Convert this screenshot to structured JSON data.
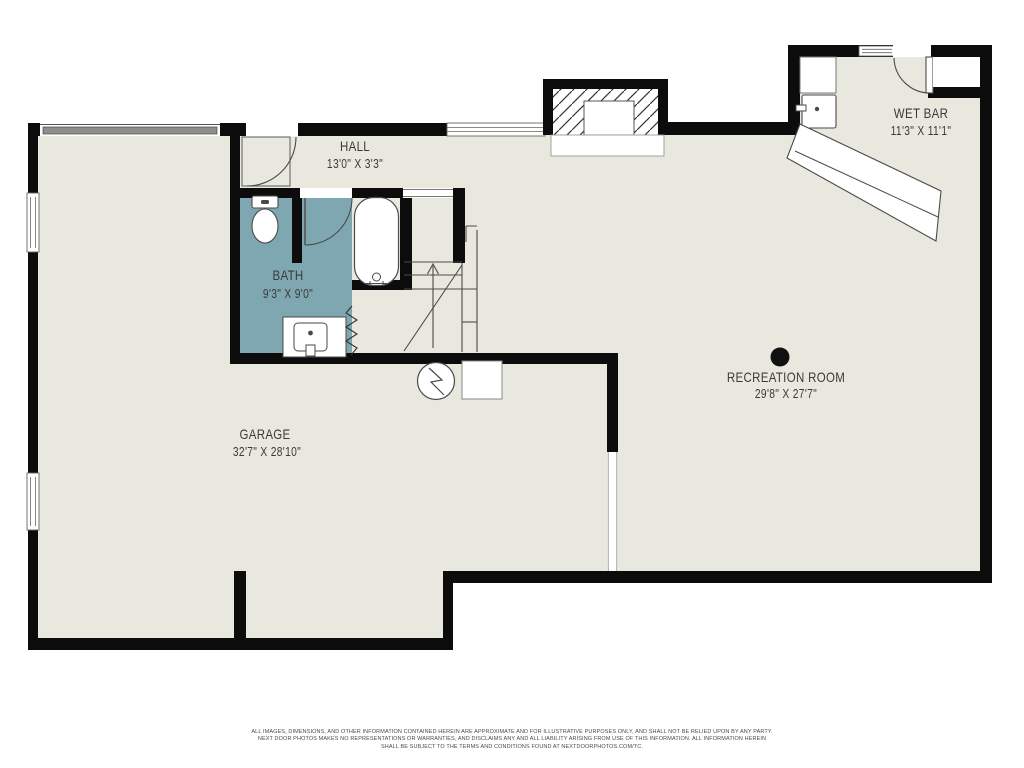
{
  "rooms": [
    {
      "name": "HALL",
      "dims": "13'0\" X 3'3\""
    },
    {
      "name": "BATH",
      "dims": "9'3\" X 9'0\""
    },
    {
      "name": "GARAGE",
      "dims": "32'7\" X 28'10\""
    },
    {
      "name": "RECREATION ROOM",
      "dims": "29'8\" X 27'7\""
    },
    {
      "name": "WET BAR",
      "dims": "11'3\" X 11'1\""
    }
  ],
  "disclaimer": {
    "line1": "ALL IMAGES, DIMENSIONS, AND OTHER INFORMATION CONTAINED HEREIN ARE APPROXIMATE AND FOR ILLUSTRATIVE PURPOSES ONLY, AND SHALL NOT BE RELIED UPON BY ANY PARTY.",
    "line2": "NEXT DOOR PHOTOS MAKES NO REPRESENTATIONS OR WARRANTIES, AND DISCLAIMS ANY AND ALL LIABILITY ARISING FROM USE OF THIS INFORMATION. ALL INFORMATION HEREIN",
    "line3": "SHALL BE SUBJECT TO THE TERMS AND CONDITIONS FOUND AT NEXTDOORPHOTOS.COM/TC."
  },
  "colors": {
    "background": "#ffffff",
    "floor": "#e9e8df",
    "bath_floor": "#7fa7b1",
    "wall": "#0c0c0c",
    "garage_door": "#8e8e8e",
    "fixture_line": "#4a4a4a",
    "label_text": "#3a3a3a"
  },
  "icons": {
    "garage-door": "gray-band",
    "window": "white-band-double-line",
    "door-swing": "quarter-arc",
    "stairs-up": "treads-with-up-arrow",
    "water-heater": "circle-with-bolt",
    "furnace": "outlined-square",
    "fireplace": "hatched-block-with-hearth",
    "support-column": "filled-circle",
    "toilet": "tank-and-bowl",
    "bathtub": "rounded-rect-with-faucet",
    "vanity-sink": "counter-with-basin-dot",
    "wet-bar-fridge": "square-with-handle",
    "bar-counter": "diagonal-band"
  }
}
